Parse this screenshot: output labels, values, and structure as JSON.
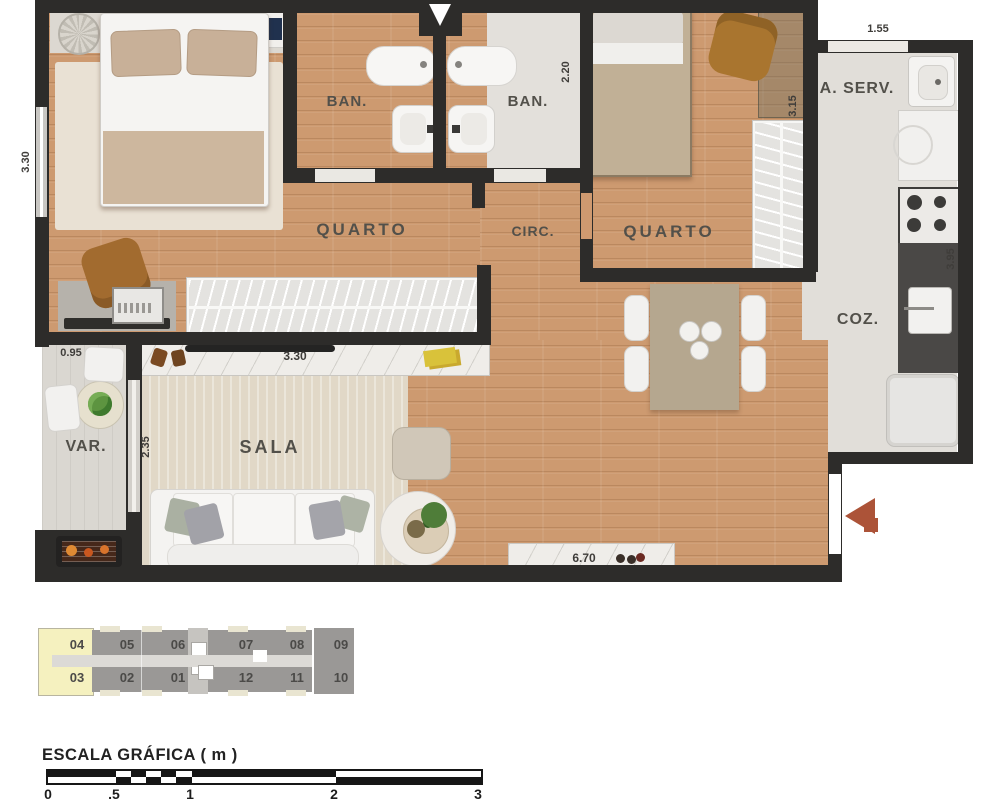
{
  "floorplan": {
    "rooms": {
      "quarto1": "QUARTO",
      "ban1": "BAN.",
      "ban2": "BAN.",
      "quarto2": "QUARTO",
      "circ": "CIRC.",
      "aserv": "A. SERV.",
      "coz": "COZ.",
      "sala": "SALA",
      "var": "VAR."
    },
    "dimensions": {
      "left_height": "3.30",
      "ban_depth": "2.20",
      "quarto2_depth": "3.15",
      "aserv_width": "1.55",
      "coz_depth": "3.95",
      "var_width": "0.95",
      "sala_depth": "2.35",
      "closet_width": "3.30",
      "sala_width": "6.70"
    }
  },
  "keyplan": {
    "top_row": [
      "04",
      "05",
      "06",
      "07",
      "08",
      "09"
    ],
    "bottom_row": [
      "03",
      "02",
      "01",
      "12",
      "11",
      "10"
    ],
    "highlighted_units": [
      "04",
      "03"
    ],
    "highlight_color": "#f5f1bf"
  },
  "scalebar": {
    "title": "ESCALA GRÁFICA ( m )",
    "ticks": [
      "0",
      ".5",
      "1",
      "2",
      "3"
    ]
  },
  "colors": {
    "wall": "#2d2c2a",
    "wood_floor": "#cd9a70",
    "tile_floor": "#e1ded9",
    "entry_arrow": "#ac5338"
  }
}
